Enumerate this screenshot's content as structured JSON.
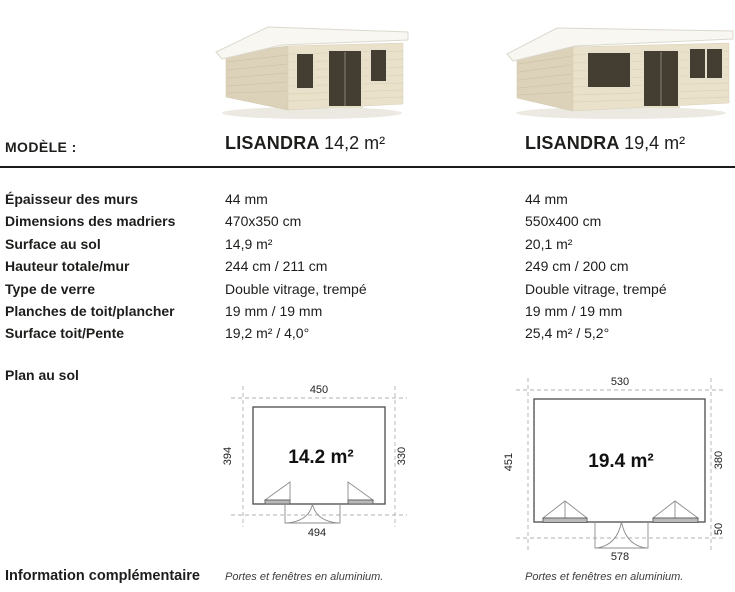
{
  "header": {
    "row_label": "MODÈLE :",
    "models": [
      {
        "name": "LISANDRA",
        "size": "14,2 m²"
      },
      {
        "name": "LISANDRA",
        "size": "19,4 m²"
      }
    ]
  },
  "specs": {
    "rows": [
      {
        "label": "Épaisseur des murs",
        "values": [
          "44 mm",
          "44 mm"
        ]
      },
      {
        "label": "Dimensions des madriers",
        "values": [
          "470x350 cm",
          "550x400 cm"
        ]
      },
      {
        "label": "Surface au sol",
        "values": [
          "14,9 m²",
          "20,1 m²"
        ]
      },
      {
        "label": "Hauteur totale/mur",
        "values": [
          "244 cm / 211 cm",
          "249 cm / 200 cm"
        ]
      },
      {
        "label": "Type de verre",
        "values": [
          "Double vitrage, trempé",
          "Double vitrage, trempé"
        ]
      },
      {
        "label": "Planches de toit/plancher",
        "values": [
          "19 mm / 19 mm",
          "19 mm / 19 mm"
        ]
      },
      {
        "label": "Surface toit/Pente",
        "values": [
          "19,2 m² / 4,0°",
          "25,4 m² / 5,2°"
        ]
      }
    ]
  },
  "floor_plans": {
    "section_label": "Plan au sol",
    "plans": [
      {
        "area": "14.2 m²",
        "width_top": "450",
        "depth_left": "394",
        "depth_right": "330",
        "width_bottom": "494"
      },
      {
        "area": "19.4 m²",
        "width_top": "530",
        "depth_left": "451",
        "depth_right": "380",
        "width_bottom": "578",
        "overhang_right": "50"
      }
    ]
  },
  "footer": {
    "label": "Information complémentaire",
    "notes": [
      "Portes et fenêtres en aluminium.",
      "Portes et fenêtres en aluminium."
    ]
  },
  "colors": {
    "text": "#1d1d1b",
    "rule": "#1a1a1a",
    "cabin_wall_front": "#eae1cb",
    "cabin_wall_side": "#dcd2ba",
    "cabin_roof": "#f8f7f2",
    "cabin_glass": "#433d32",
    "cabin_shadow": "#ebe9e1",
    "plan_line": "#4c4c4c"
  }
}
